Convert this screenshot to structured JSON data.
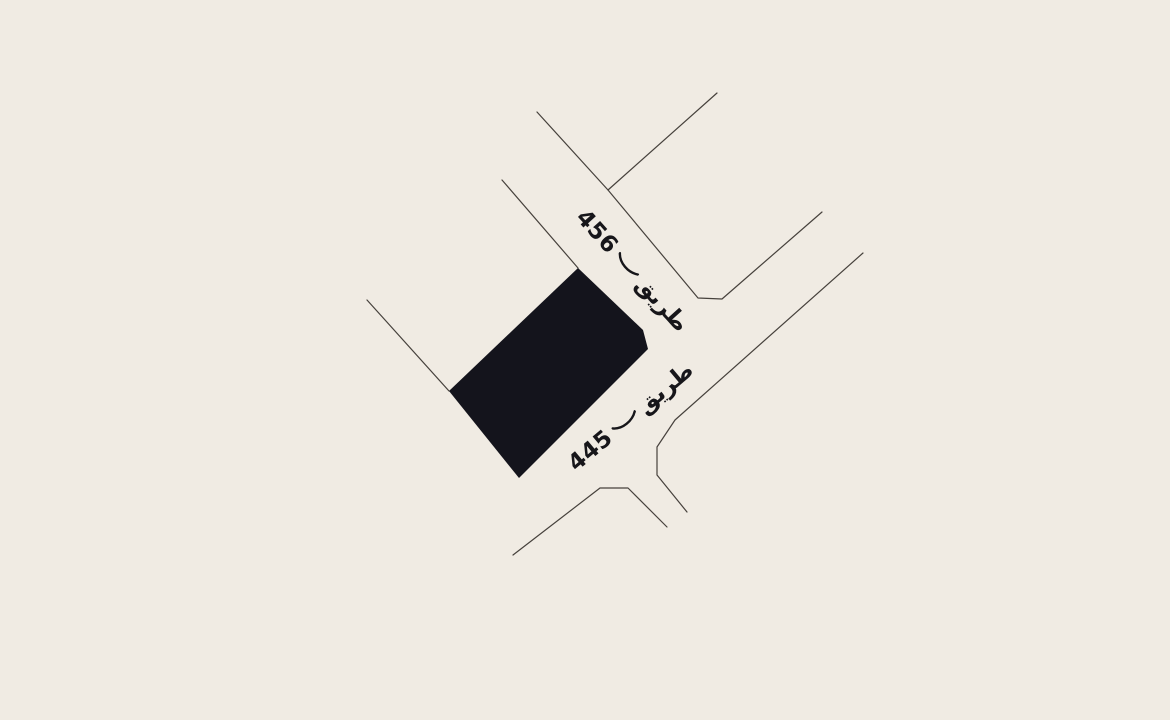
{
  "canvas": {
    "width": 1170,
    "height": 720,
    "background": "#f0ebe3"
  },
  "map": {
    "type": "parcel-location-map",
    "text_color": "#17161a",
    "road_line_color": "#46413c",
    "parcel": {
      "fill": "#14141c",
      "points": [
        [
          578,
          268
        ],
        [
          643,
          330
        ],
        [
          648,
          349
        ],
        [
          519,
          478
        ],
        [
          449,
          391
        ]
      ]
    },
    "geometry": {
      "roads": [
        [
          [
            537,
            112
          ],
          [
            608,
            190
          ]
        ],
        [
          [
            717,
            93
          ],
          [
            608,
            190
          ],
          [
            698,
            298
          ],
          [
            722,
            299
          ],
          [
            822,
            212
          ]
        ],
        [
          [
            502,
            180
          ],
          [
            578,
            268
          ]
        ],
        [
          [
            367,
            300
          ],
          [
            449,
            391
          ]
        ],
        [
          [
            863,
            253
          ],
          [
            675,
            420
          ],
          [
            657,
            447
          ],
          [
            657,
            475
          ],
          [
            687,
            512
          ]
        ],
        [
          [
            513,
            555
          ],
          [
            600,
            488
          ],
          [
            628,
            488
          ],
          [
            667,
            527
          ]
        ]
      ]
    },
    "labels": {
      "road_456": {
        "word": "طريق",
        "number": "456",
        "full": "طريق 456"
      },
      "road_445": {
        "word": "طريق",
        "number": "445",
        "full": "طريق 445"
      }
    }
  }
}
